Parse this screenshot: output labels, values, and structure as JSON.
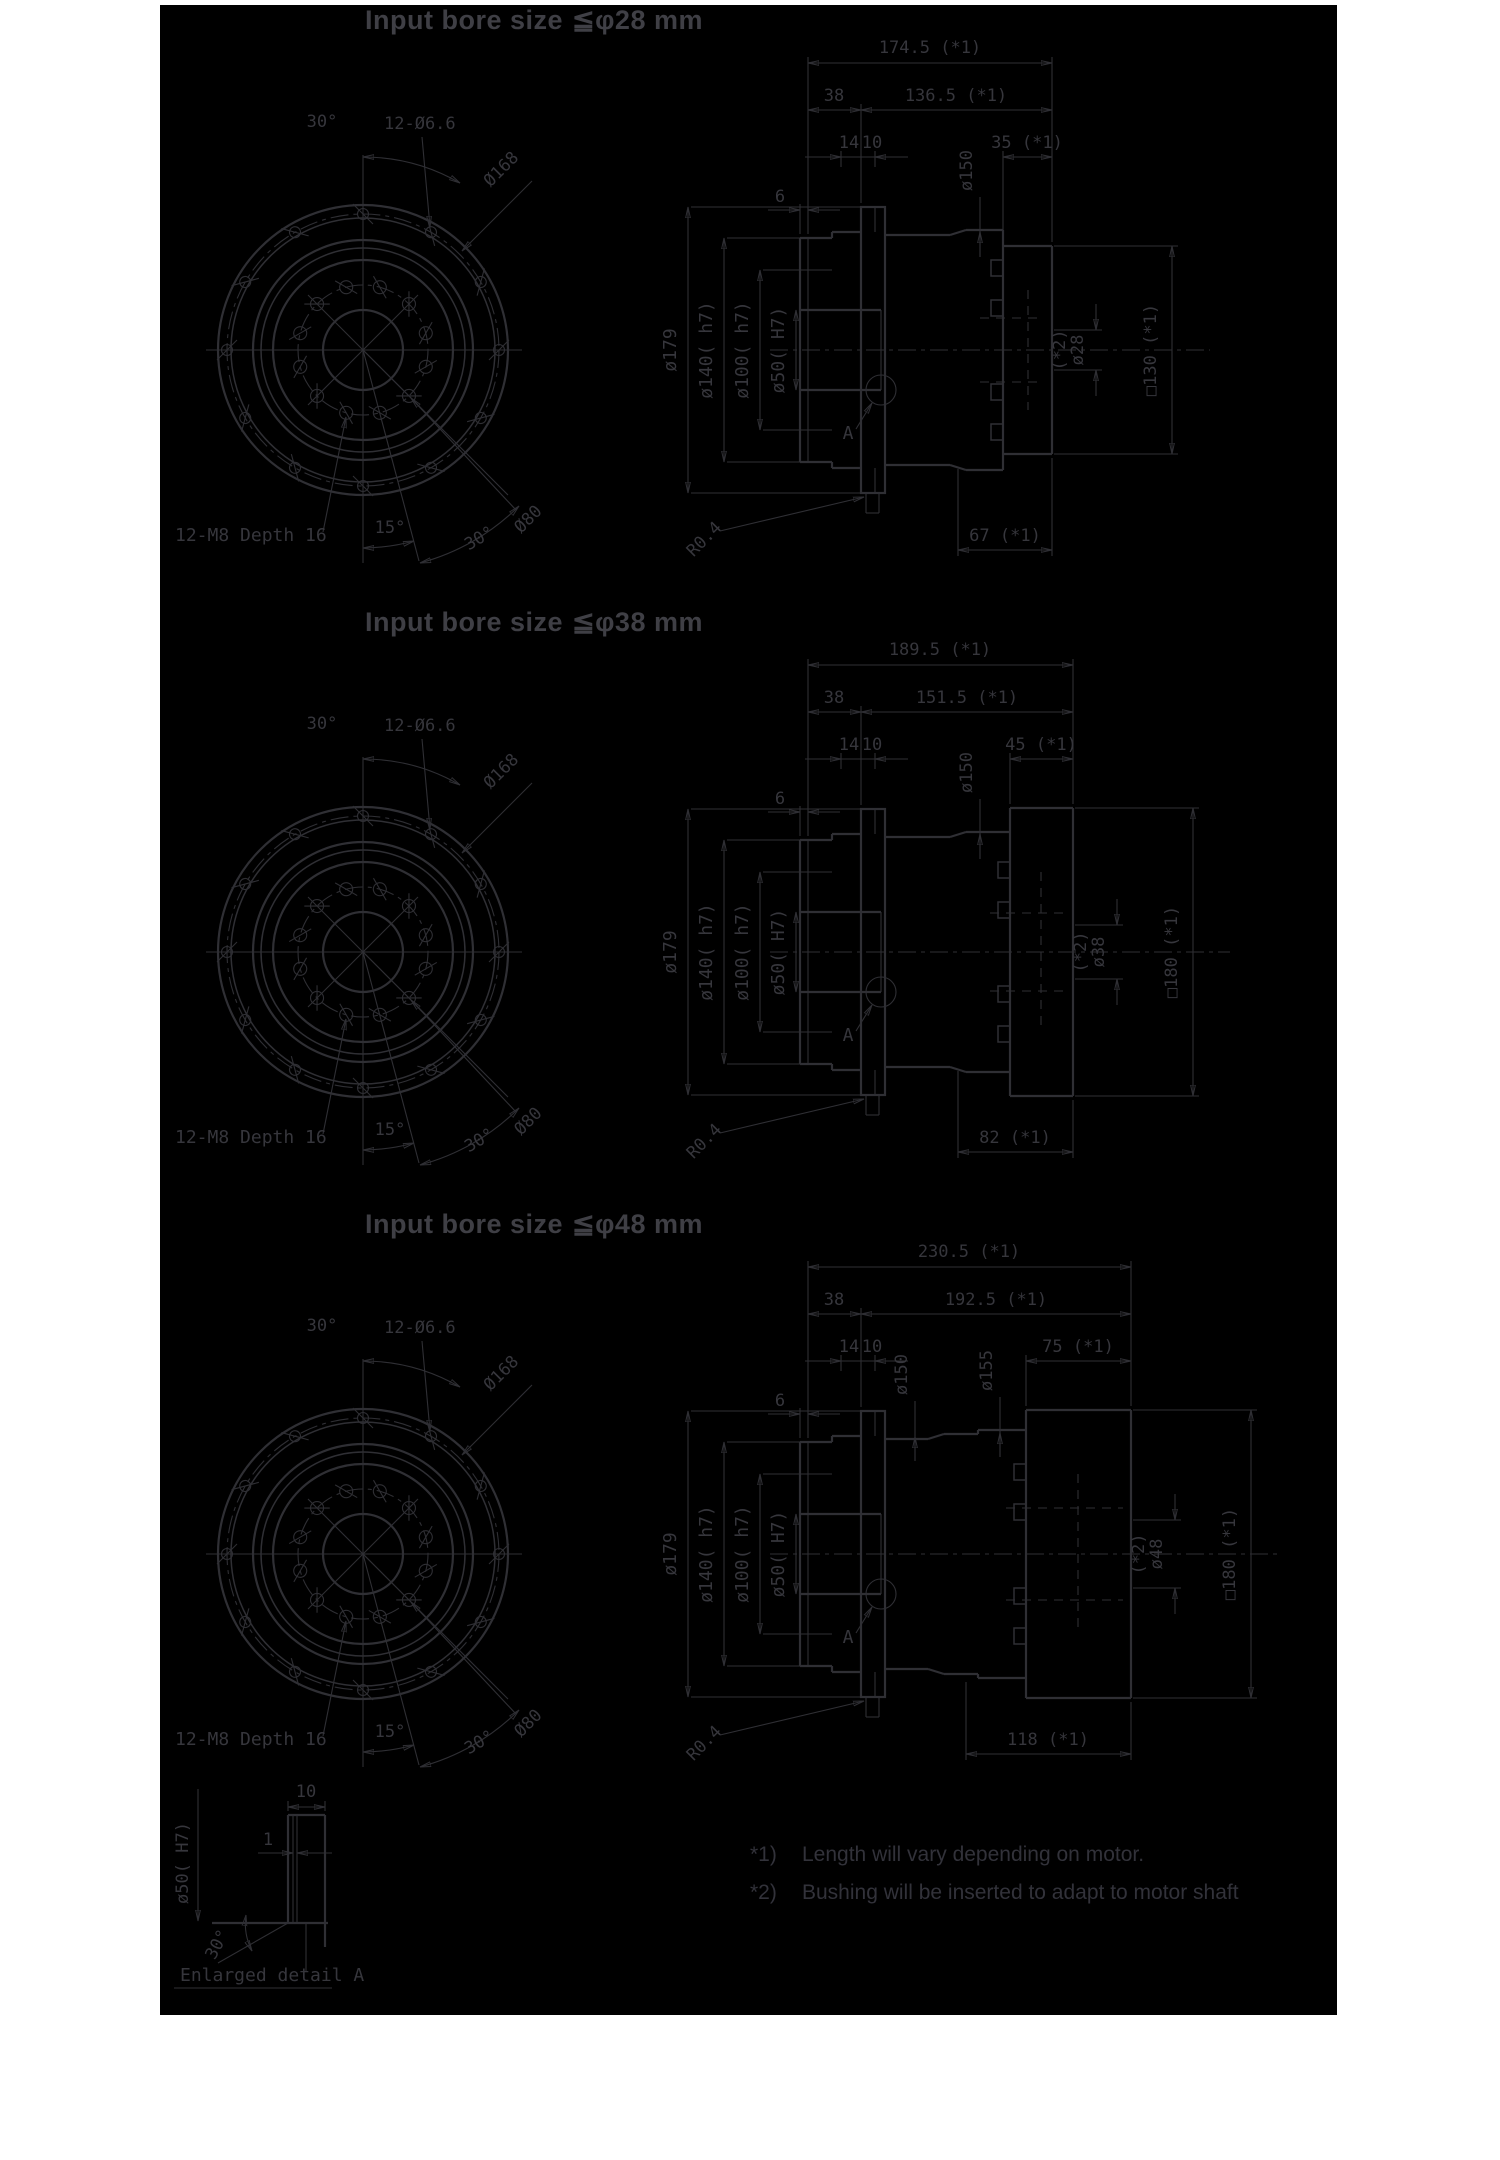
{
  "page": {
    "background": "#ffffff",
    "canvas_background": "#000000",
    "line_color": "#2f2f34",
    "dim_text_color": "#36363c",
    "title_color": "#3f3f45"
  },
  "sections": [
    {
      "title": {
        "label": "Input bore size",
        "value": "≦φ28 mm"
      },
      "front": {
        "angle_top": "30°",
        "bolt_spec": "12-Ø6.6",
        "bolt_circle_dia": "Ø168",
        "inner_bolt_circle_dia": "Ø80",
        "tap_spec": "12-M8 Depth 16",
        "angle_bottom_left": "15°",
        "angle_bottom_right": "30°"
      },
      "side": {
        "overall_len": "174.5 (*1)",
        "front_len": "38",
        "rear_len": "136.5 (*1)",
        "flange_len": "14",
        "pilot_len": "10",
        "motor_len": "35 (*1)",
        "step_len": "6",
        "body_dia": "ø150",
        "flange_dia": "ø179",
        "boss_dia": "ø140( h7)",
        "pilot_dia": "ø100( h7)",
        "bore_dia": "ø50( H7)",
        "detail_ref": "A",
        "fillet": "R0.4",
        "rear_overhang": "67 (*1)",
        "bushing_ref": "(*2)",
        "input_bore": "ø28",
        "motor_frame": "□130 (*1)"
      }
    },
    {
      "title": {
        "label": "Input bore size",
        "value": "≦φ38 mm"
      },
      "front": {
        "angle_top": "30°",
        "bolt_spec": "12-Ø6.6",
        "bolt_circle_dia": "Ø168",
        "inner_bolt_circle_dia": "Ø80",
        "tap_spec": "12-M8 Depth 16",
        "angle_bottom_left": "15°",
        "angle_bottom_right": "30°"
      },
      "side": {
        "overall_len": "189.5 (*1)",
        "front_len": "38",
        "rear_len": "151.5 (*1)",
        "flange_len": "14",
        "pilot_len": "10",
        "motor_len": "45 (*1)",
        "step_len": "6",
        "body_dia": "ø150",
        "flange_dia": "ø179",
        "boss_dia": "ø140( h7)",
        "pilot_dia": "ø100( h7)",
        "bore_dia": "ø50( H7)",
        "detail_ref": "A",
        "fillet": "R0.4",
        "rear_overhang": "82 (*1)",
        "bushing_ref": "(*2)",
        "input_bore": "ø38",
        "motor_frame": "□180 (*1)"
      }
    },
    {
      "title": {
        "label": "Input bore size",
        "value": "≦φ48 mm"
      },
      "front": {
        "angle_top": "30°",
        "bolt_spec": "12-Ø6.6",
        "bolt_circle_dia": "Ø168",
        "inner_bolt_circle_dia": "Ø80",
        "tap_spec": "12-M8 Depth 16",
        "angle_bottom_left": "15°",
        "angle_bottom_right": "30°"
      },
      "side": {
        "overall_len": "230.5 (*1)",
        "front_len": "38",
        "rear_len": "192.5 (*1)",
        "flange_len": "14",
        "pilot_len": "10",
        "motor_len": "75 (*1)",
        "step_len": "6",
        "body_dia": "ø150",
        "body_dia2": "ø155",
        "flange_dia": "ø179",
        "boss_dia": "ø140( h7)",
        "pilot_dia": "ø100( h7)",
        "bore_dia": "ø50( H7)",
        "detail_ref": "A",
        "fillet": "R0.4",
        "rear_overhang": "118 (*1)",
        "bushing_ref": "(*2)",
        "input_bore": "ø48",
        "motor_frame": "□180 (*1)"
      }
    }
  ],
  "detail": {
    "caption": "Enlarged detail A",
    "plate_width": "10",
    "groove_width": "1",
    "bore_dia": "ø50( H7)",
    "chamfer_angle": "30°"
  },
  "notes": {
    "ref1": "*1)",
    "text1": "Length will vary depending on motor.",
    "ref2": "*2)",
    "text2": "Bushing will be inserted to adapt to motor shaft"
  }
}
